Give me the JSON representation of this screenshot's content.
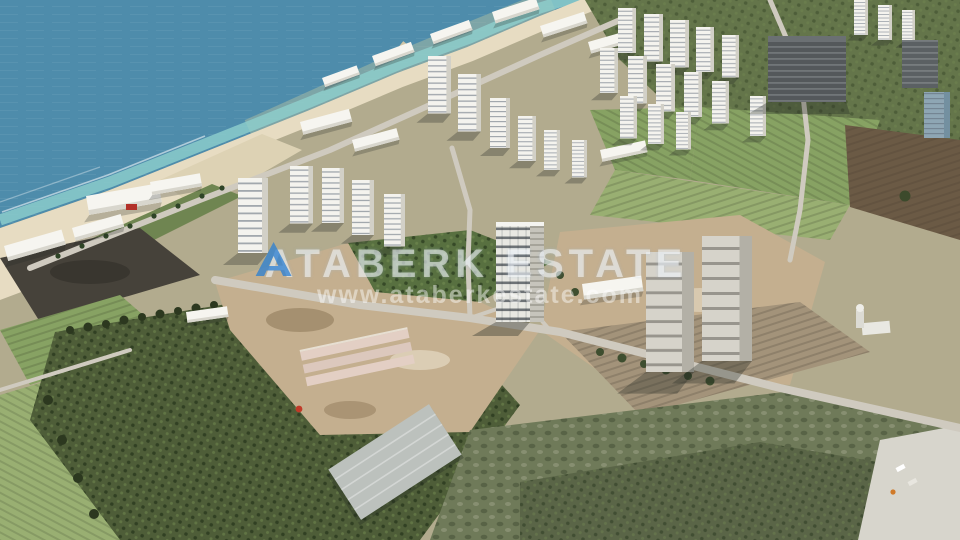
{
  "watermark": {
    "brand": "ATABERK ESTATE",
    "url": "www.ataberkestate.com",
    "logo_icon": "ataberk-logo",
    "logo_color": "#2a7fd4",
    "text_color": "#ffffff"
  },
  "palette": {
    "land_base": "#b2ab8e",
    "sea_deep": "#4e8cab",
    "sea_mid": "#6aa3ba",
    "sea_shallow": "#8fd0cd",
    "sea_sediment": "#b9c4a2",
    "sand": "#e7dcc2",
    "dune": "#ddd2b4",
    "promenade": "#6f8551",
    "veg_dark": "#64754a",
    "field_green": "#87a263",
    "field_green_light": "#99af72",
    "field_brown": "#6b5a45",
    "plowed_dark": "#46423a",
    "orchard_green": "#4e5d38",
    "orchard_center": "#587040",
    "dirt": "#c4af8f",
    "dirt_rows": "#a3937a",
    "scrub": "#6f7a59",
    "olive": "#5a6547",
    "gravel": "#d7d5cc",
    "road": "#cfcabf",
    "building_white": "#f4f3ee",
    "building_shade": "#d2d0c7",
    "concrete": "#d6d3ca",
    "dark_building": "#54585b",
    "glass_building": "#8ea6b4",
    "warehouse": "#bcc1bd",
    "foundation": "#e3cfc4"
  },
  "scene": {
    "type": "aerial-drone-photograph",
    "features": [
      "sea",
      "shoreline-beach",
      "pier",
      "beachfront-resort",
      "white-highrise-district",
      "dark-concrete-complex",
      "central-construction-tower",
      "twin-construction-towers",
      "green-crop-fields",
      "brown-plowed-fields",
      "orchard-grove",
      "construction-site",
      "warehouse-under-construction",
      "dirt-roads",
      "scrubland",
      "gravel-lot"
    ]
  }
}
